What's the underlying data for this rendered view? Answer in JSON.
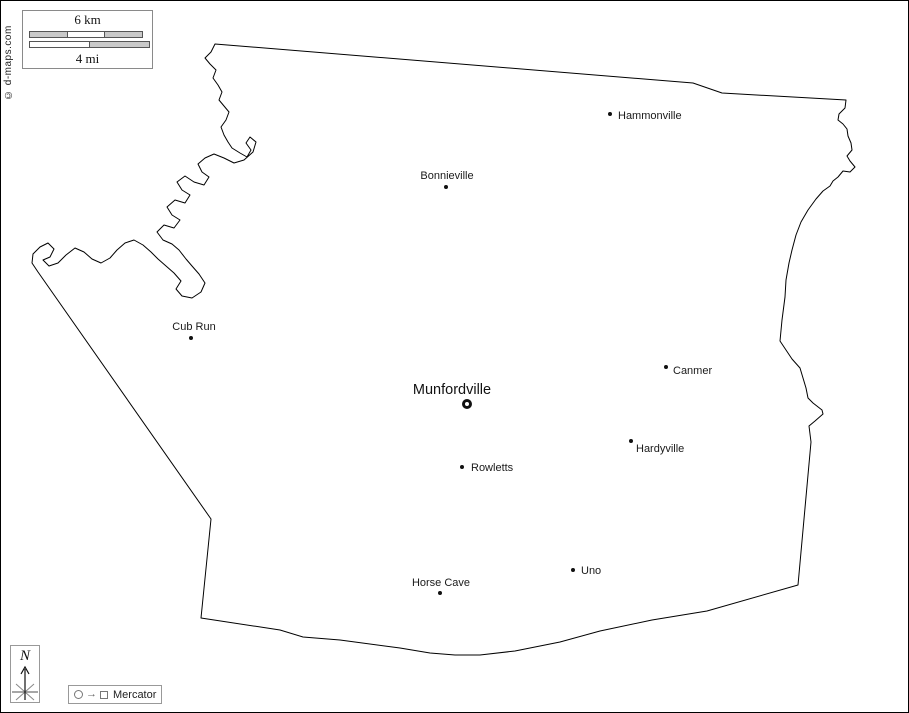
{
  "watermark": {
    "text": "© d-maps.com"
  },
  "scale_bar": {
    "km": "6 km",
    "mi": "4 mi"
  },
  "compass": {
    "north": "N"
  },
  "legend": {
    "projection": "Mercator",
    "arrow": "→"
  },
  "colors": {
    "outline": "#000000",
    "label_text": "#1a1a1a",
    "scale_gray": "#c9c9c9",
    "box_border": "#8a8a8a"
  },
  "map": {
    "towns": [
      {
        "name": "Hammonville",
        "x": 610,
        "y": 114,
        "dx": 8,
        "dy": -4,
        "align": "left",
        "seat": false
      },
      {
        "name": "Bonnieville",
        "x": 446,
        "y": 187,
        "dx": 1,
        "dy": -17,
        "align": "center",
        "seat": false
      },
      {
        "name": "Cub Run",
        "x": 191,
        "y": 338,
        "dx": 3,
        "dy": -17,
        "align": "center",
        "seat": false
      },
      {
        "name": "Munfordville",
        "x": 467,
        "y": 404,
        "dx": -15,
        "dy": -22,
        "align": "center",
        "seat": true
      },
      {
        "name": "Canmer",
        "x": 666,
        "y": 367,
        "dx": 7,
        "dy": -2,
        "align": "left",
        "seat": false
      },
      {
        "name": "Hardyville",
        "x": 631,
        "y": 441,
        "dx": 5,
        "dy": 2,
        "align": "left",
        "seat": false
      },
      {
        "name": "Rowletts",
        "x": 462,
        "y": 467,
        "dx": 9,
        "dy": -5,
        "align": "left",
        "seat": false
      },
      {
        "name": "Horse Cave",
        "x": 440,
        "y": 593,
        "dx": 1,
        "dy": -16,
        "align": "center",
        "seat": false
      },
      {
        "name": "Uno",
        "x": 573,
        "y": 570,
        "dx": 8,
        "dy": -5,
        "align": "left",
        "seat": false
      }
    ]
  }
}
